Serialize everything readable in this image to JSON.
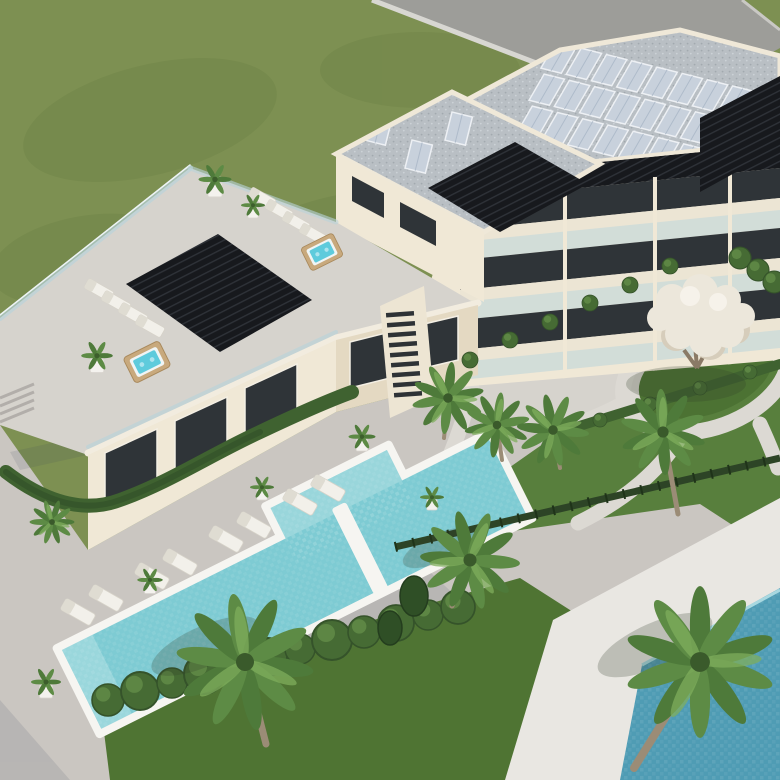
{
  "scene": {
    "type": "architectural-aerial-render",
    "description": "Aerial 3D rendering of a modern cream-coloured apartment complex with rooftop solar panels, rooftop terraces with pergolas, hot tubs and sun loungers, a long turquoise swimming pool with a pocket section, the corner of a second deeper-blue pool, palm trees, hedges, a white flowering tree on a lawn island and curved garden paths",
    "objects": [
      "green lawn",
      "access road",
      "apartment building",
      "solar panel arrays",
      "gravel roof",
      "rooftop terrace",
      "black pergolas",
      "sun loungers",
      "hot tubs",
      "glass balustrades",
      "balconies",
      "external staircase",
      "sliding glass doors",
      "main swimming pool",
      "pool divider walkway",
      "corner swimming pool",
      "pool deck",
      "potted plants",
      "palm trees",
      "round bushes",
      "hedges",
      "garden fence",
      "white flowering tree",
      "lawn island",
      "curved garden paths"
    ],
    "counts": {
      "swimming_pools": 2,
      "hot_tubs": 2,
      "sun_loungers": 16,
      "palm_trees": 8,
      "potted_plants": 9
    }
  },
  "palette": {
    "lawn": "#7d9052",
    "lawn_shade": "#697e42",
    "garden_lawn": "#587f3d",
    "dark_lawn": "#4f7433",
    "island_lawn": "#4c7233",
    "road": "#9d9d99",
    "curb": "#d8d7d2",
    "deck": "#cac6c1",
    "courtyard": "#d6d3cd",
    "path": "#dcd9d3",
    "pool_rim": "#f6f5f1",
    "pool_water": "#7ecbd3",
    "pool_shallow": "#aee0e2",
    "corner_pool_water": "#4f9cb4",
    "corner_pool_deck": "#e9e7e2",
    "wall": "#f0e8d6",
    "wall_shade": "#e4d9c2",
    "slab": "#ece5d4",
    "window": "#2f3438",
    "glass": "#bad4da",
    "pergola": "#17191d",
    "roof_gravel": "#b9bfc4",
    "solar": "#c8d1dc",
    "solar_frame": "#edf0f4",
    "hedge": "#3f6230",
    "fence": "#2d4426",
    "bush": "#466b34",
    "bush_dark": "#35532a",
    "palm": "#4e7a3a",
    "palm_light": "#7fae5c",
    "trunk": "#9b8c76",
    "flower_tree": "#ece7db",
    "flower_tree_shade": "#d6cdbb",
    "lounger": "#f2f0ea",
    "lounger_shade": "#dfdcd2",
    "hot_tub_wood": "#c8a97d",
    "hot_tub_water": "#5ecbdc",
    "pot": "#f4f2ee",
    "stair": "#2e3236",
    "shadow": "#32402c"
  }
}
